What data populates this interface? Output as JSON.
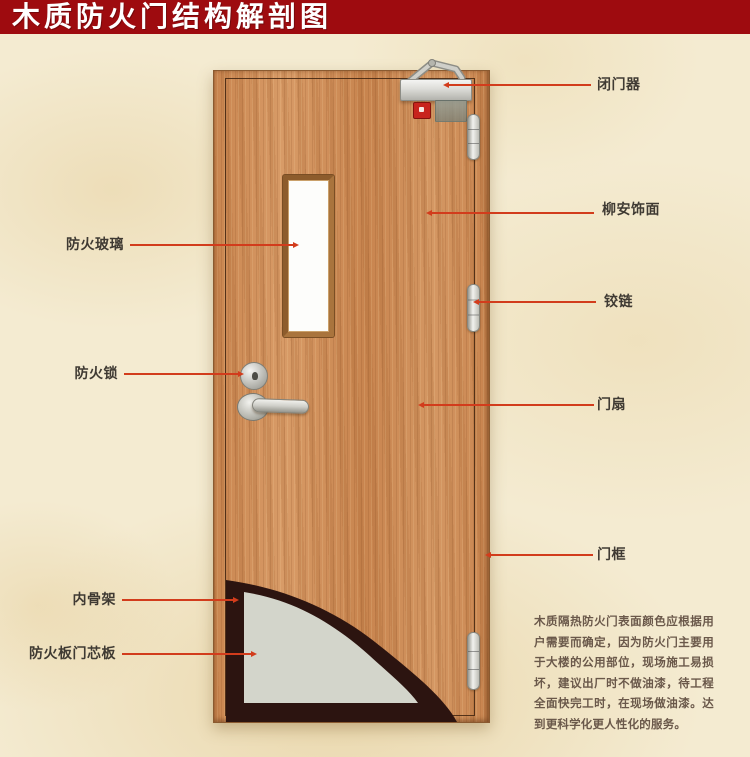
{
  "title": "木质防火门结构解剖图",
  "annotations": {
    "left": [
      {
        "id": "fire-glass",
        "text": "防火玻璃"
      },
      {
        "id": "fire-lock",
        "text": "防火锁"
      },
      {
        "id": "inner-skeleton",
        "text": "内骨架"
      },
      {
        "id": "fire-core-board",
        "text": "防火板门芯板"
      }
    ],
    "right": [
      {
        "id": "door-closer",
        "text": "闭门器"
      },
      {
        "id": "lauan-veneer",
        "text": "柳安饰面"
      },
      {
        "id": "hinge",
        "text": "铰链"
      },
      {
        "id": "door-leaf",
        "text": "门扇"
      },
      {
        "id": "door-frame",
        "text": "门框"
      }
    ]
  },
  "description": "木质隔热防火门表面颜色应根据用户需要而确定，因为防火门主要用于大楼的公用部位，现场施工易损坏，建议出厂时不做油漆，待工程全面快完工时，在现场做油漆。达到更科学化更人性化的服务。",
  "colors": {
    "banner_red": "#9e0b0f",
    "leader_line_red": "#d23c1c",
    "wood": "#cf9160",
    "skeleton_dark": "#2c1410",
    "core_gray": "#d3d5cb",
    "background_cream": "#f4ebd1",
    "label_text": "#3f3a33",
    "description_text": "#6a584a"
  }
}
